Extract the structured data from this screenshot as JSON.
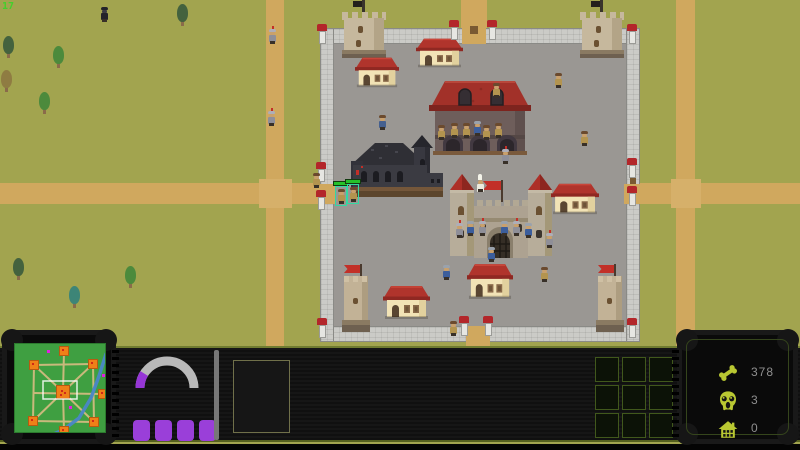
{
  "fps": "17",
  "hud": {
    "resources": [
      {
        "icon": "bone-icon",
        "value": "378"
      },
      {
        "icon": "skull-icon",
        "value": "3"
      },
      {
        "icon": "house-icon",
        "value": "0"
      }
    ],
    "gauge": {
      "fill_pct": 18,
      "track_color": "#b9b9b9",
      "fill_color": "#9636d6"
    },
    "charge_bars": 4,
    "action_grid": {
      "rows": 3,
      "cols": 3
    },
    "minimap": {
      "screen_color": "#3f9f41",
      "road_color": "#c9b97c",
      "node_color": "#ef8018",
      "river_color": "#4a86c8",
      "dot_color": "#e020e0",
      "nodes": [
        {
          "x": 49,
          "y": 7
        },
        {
          "x": 19,
          "y": 21
        },
        {
          "x": 78,
          "y": 20
        },
        {
          "x": 48,
          "y": 48,
          "main": true
        },
        {
          "x": 88,
          "y": 50
        },
        {
          "x": 18,
          "y": 77
        },
        {
          "x": 79,
          "y": 78
        },
        {
          "x": 49,
          "y": 87
        }
      ],
      "roads": [
        [
          19,
          21,
          78,
          20
        ],
        [
          78,
          20,
          79,
          78
        ],
        [
          79,
          78,
          18,
          77
        ],
        [
          18,
          77,
          19,
          21
        ],
        [
          19,
          21,
          48,
          48
        ],
        [
          78,
          20,
          48,
          48
        ],
        [
          18,
          77,
          48,
          48
        ],
        [
          79,
          78,
          48,
          48
        ],
        [
          49,
          7,
          48,
          48
        ],
        [
          48,
          48,
          49,
          87
        ],
        [
          18,
          49,
          88,
          50
        ]
      ],
      "river": [
        [
          91,
          10
        ],
        [
          84,
          32
        ],
        [
          76,
          54
        ],
        [
          64,
          74
        ],
        [
          48,
          86
        ],
        [
          34,
          92
        ]
      ],
      "view_rect": [
        28,
        37,
        34,
        18
      ],
      "dots": [
        [
          32,
          6
        ],
        [
          87,
          30
        ],
        [
          54,
          62
        ]
      ]
    }
  },
  "world": {
    "colors": {
      "grass": "#a2a44f",
      "road": "#d0a85e",
      "town_floor": "#9a9793",
      "wall": "#cbcbc7",
      "roof_red": "#b0342c",
      "flag_red": "#c22f28",
      "accent_purple": "#9a3fd9",
      "icon_green": "#b9c832"
    },
    "posts": [
      {
        "x": 317,
        "y": 24
      },
      {
        "x": 627,
        "y": 24
      },
      {
        "x": 317,
        "y": 318
      },
      {
        "x": 627,
        "y": 318
      },
      {
        "x": 449,
        "y": 20
      },
      {
        "x": 487,
        "y": 20
      },
      {
        "x": 459,
        "y": 316
      },
      {
        "x": 483,
        "y": 316
      },
      {
        "x": 316,
        "y": 162
      },
      {
        "x": 316,
        "y": 190
      },
      {
        "x": 627,
        "y": 158
      },
      {
        "x": 627,
        "y": 186
      }
    ],
    "houses": [
      {
        "x": 355,
        "y": 55,
        "w": 44,
        "h": 34
      },
      {
        "x": 416,
        "y": 36,
        "w": 47,
        "h": 33
      },
      {
        "x": 551,
        "y": 181,
        "w": 48,
        "h": 35
      },
      {
        "x": 467,
        "y": 261,
        "w": 46,
        "h": 40
      },
      {
        "x": 383,
        "y": 283,
        "w": 47,
        "h": 38
      }
    ],
    "trees": [
      {
        "x": 2,
        "y": 36,
        "v": "dark"
      },
      {
        "x": 0,
        "y": 70,
        "v": "brown"
      },
      {
        "x": 52,
        "y": 46,
        "v": "green"
      },
      {
        "x": 38,
        "y": 92,
        "v": "green"
      },
      {
        "x": 176,
        "y": 4,
        "v": "dark"
      },
      {
        "x": 12,
        "y": 258,
        "v": "dark"
      },
      {
        "x": 124,
        "y": 266,
        "v": "green"
      },
      {
        "x": 68,
        "y": 286,
        "v": "teal"
      }
    ],
    "units": [
      {
        "t": "dark",
        "x": 100,
        "y": 6
      },
      {
        "t": "knight",
        "x": 268,
        "y": 28
      },
      {
        "t": "knight",
        "x": 267,
        "y": 110
      },
      {
        "t": "villager",
        "x": 312,
        "y": 172
      },
      {
        "t": "villager",
        "x": 337,
        "y": 188,
        "sel": true
      },
      {
        "t": "villager",
        "x": 349,
        "y": 186,
        "sel": true
      },
      {
        "t": "villager-blue",
        "x": 378,
        "y": 114
      },
      {
        "t": "villager",
        "x": 492,
        "y": 82
      },
      {
        "t": "villager",
        "x": 437,
        "y": 124
      },
      {
        "t": "villager",
        "x": 450,
        "y": 122
      },
      {
        "t": "villager",
        "x": 462,
        "y": 122
      },
      {
        "t": "soldier",
        "x": 473,
        "y": 120
      },
      {
        "t": "villager",
        "x": 482,
        "y": 124
      },
      {
        "t": "villager",
        "x": 494,
        "y": 122
      },
      {
        "t": "knight",
        "x": 501,
        "y": 148
      },
      {
        "t": "villager",
        "x": 554,
        "y": 72
      },
      {
        "t": "villager",
        "x": 580,
        "y": 130
      },
      {
        "t": "pope",
        "x": 476,
        "y": 176
      },
      {
        "t": "knight",
        "x": 455,
        "y": 222
      },
      {
        "t": "soldier",
        "x": 466,
        "y": 220
      },
      {
        "t": "knight",
        "x": 478,
        "y": 220
      },
      {
        "t": "soldier",
        "x": 500,
        "y": 220
      },
      {
        "t": "knight",
        "x": 512,
        "y": 220
      },
      {
        "t": "soldier",
        "x": 524,
        "y": 222
      },
      {
        "t": "knight",
        "x": 545,
        "y": 232
      },
      {
        "t": "soldier",
        "x": 487,
        "y": 246
      },
      {
        "t": "soldier",
        "x": 442,
        "y": 264
      },
      {
        "t": "villager",
        "x": 540,
        "y": 266
      },
      {
        "t": "villager",
        "x": 449,
        "y": 320
      }
    ]
  }
}
